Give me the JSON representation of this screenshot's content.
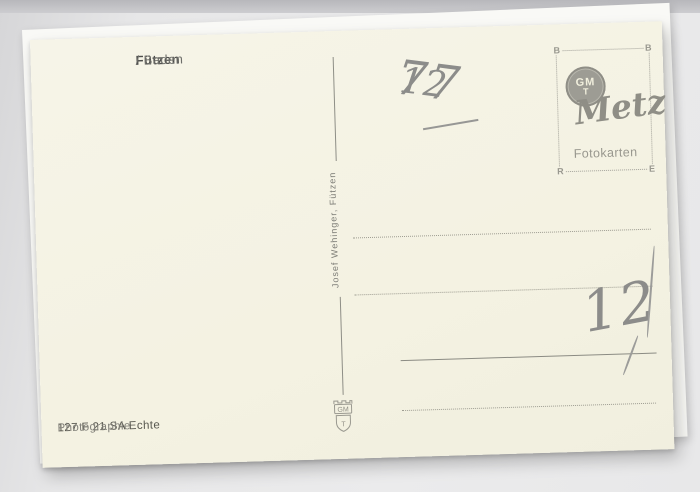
{
  "postcard": {
    "title": {
      "place": "Fützen",
      "region": "/ Baden"
    },
    "handwriting": {
      "postal_code": "7712",
      "postal_prefix": "77",
      "postal_suffix": "12",
      "price_note": "12"
    },
    "publisher_credit": "Josef Wehinger, Fützen",
    "series_code": {
      "strong": "127 F 21 SA Echte",
      "light": "Photographie"
    },
    "stamp_box": {
      "corner_top_left": "B",
      "corner_top_right": "B",
      "corner_bottom_left": "R",
      "corner_bottom_right": "E",
      "monogram_top": "GM",
      "monogram_bottom": "T",
      "brand_script": "Metz",
      "brand_subtitle": "Fotokarten"
    },
    "crest": {
      "monogram_top": "GM",
      "monogram_bottom": "T"
    }
  },
  "colors": {
    "card_paper": "#f4f2e3",
    "background": "#e9e9ea",
    "print_text": "#4d4d4b",
    "logo_gray": "#98978e",
    "handwriting_pencil": "#8c8c8a"
  }
}
